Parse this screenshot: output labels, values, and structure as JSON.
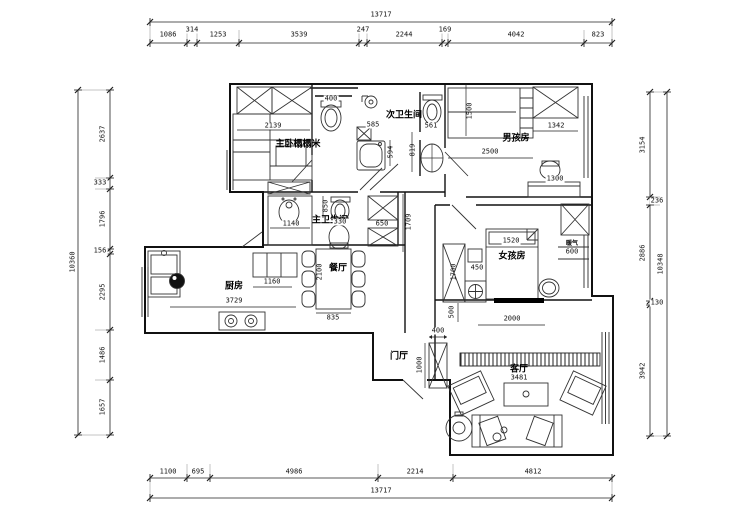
{
  "drawing": {
    "type": "apartment floor plan"
  },
  "dims": {
    "top_total": "13717",
    "top": [
      "1086",
      "314",
      "1253",
      "3539",
      "247",
      "2244",
      "169",
      "4042",
      "823"
    ],
    "bottom": [
      "1100",
      "695",
      "4986",
      "2214",
      "4812"
    ],
    "bottom_total": "13717",
    "left_total": "10360",
    "left": [
      "2637",
      "333",
      "1796",
      "156",
      "2295",
      "1486",
      "1657"
    ],
    "right": [
      "3154",
      "236",
      "2886",
      "130",
      "3942"
    ],
    "right_total": "10348"
  },
  "rooms": {
    "master_bedroom": "主卧榻榻米",
    "second_bath": "次卫生间",
    "boys_room": "男孩房",
    "master_bath": "主卫生间",
    "dining": "餐厅",
    "kitchen": "厨房",
    "girls_room": "女孩房",
    "entry": "门厅",
    "living": "客厅",
    "radiator": "暖气"
  },
  "plan_dims": {
    "master_bed_width": "2139",
    "bath2_toilet": "400",
    "bath2_a": "585",
    "bath2_b": "594",
    "bath2_c": "819",
    "bath2_d": "561",
    "boys_bed_w": "1500",
    "boys_bed_l": "2500",
    "boys_wardrobe": "1342",
    "boys_desk": "1300",
    "bath1_sink": "1140",
    "bath1_a": "850",
    "bath1_b": "330",
    "bath1_cabinet": "650",
    "bath1_depth": "1709",
    "kitchen_counter": "1160",
    "kitchen_len": "3729",
    "dining_table_l": "2100",
    "dining_table_w": "835",
    "girls_bed": "1520",
    "girls_gap": "450",
    "girls_wardrobe": "1700",
    "girls_radiator": "600",
    "girls_off": "500",
    "girls_window": "2000",
    "entry_cab_w": "400",
    "entry_cab_l": "1000",
    "living_width": "3481"
  },
  "colors": {
    "line": "#111111",
    "background": "#ffffff"
  }
}
